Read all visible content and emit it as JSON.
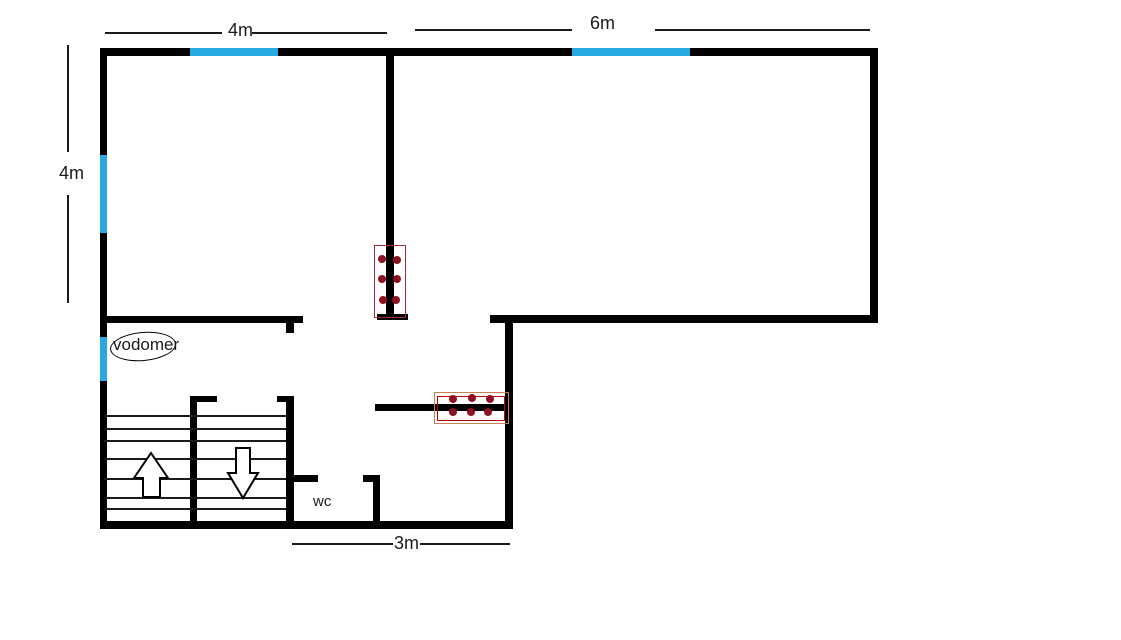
{
  "app": {
    "title": "floor-plan-sketch"
  },
  "labels": {
    "dim_top_left": "4m",
    "dim_top_right": "6m",
    "dim_left": "4m",
    "dim_bottom": "3m",
    "water_meter": "vodomer",
    "wc": "wc"
  },
  "colors": {
    "wall": "#000000",
    "window": "#29a9e1",
    "dim_line": "#1a1a1a",
    "step_line": "#1a1a1a",
    "dot": "#8e1023",
    "desk_outline_maroon": "#9b2c3b",
    "desk_outline_tan": "#c0824f",
    "desk_outline_red": "#c00000",
    "ellipse_stroke": "#000000"
  },
  "plan": {
    "walls": [
      {
        "name": "outer-top-wall",
        "x": 100,
        "y": 48,
        "w": 778,
        "h": 8
      },
      {
        "name": "outer-left-wall",
        "x": 100,
        "y": 48,
        "w": 7,
        "h": 480
      },
      {
        "name": "outer-right-wall",
        "x": 870,
        "y": 48,
        "w": 8,
        "h": 274
      },
      {
        "name": "right-room-bottom-wall",
        "x": 490,
        "y": 315,
        "w": 388,
        "h": 8
      },
      {
        "name": "hall-right-wall",
        "x": 505,
        "y": 319,
        "w": 8,
        "h": 209
      },
      {
        "name": "outer-bottom-wall",
        "x": 100,
        "y": 521,
        "w": 413,
        "h": 8
      },
      {
        "name": "center-partition-wall",
        "x": 386,
        "y": 56,
        "w": 8,
        "h": 260
      },
      {
        "name": "center-partition-foot",
        "x": 377,
        "y": 314,
        "w": 31,
        "h": 6
      },
      {
        "name": "left-room-bottom-wall",
        "x": 103,
        "y": 316,
        "w": 200,
        "h": 7
      },
      {
        "name": "left-room-wall-stub",
        "x": 286,
        "y": 323,
        "w": 8,
        "h": 10
      },
      {
        "name": "hall-desk-wall",
        "x": 375,
        "y": 404,
        "w": 132,
        "h": 7
      },
      {
        "name": "stairwell-right-wall",
        "x": 286,
        "y": 398,
        "w": 8,
        "h": 127
      },
      {
        "name": "stairwell-right-wall-stub",
        "x": 277,
        "y": 396,
        "w": 17,
        "h": 6
      },
      {
        "name": "stairs-divider-wall",
        "x": 190,
        "y": 399,
        "w": 7,
        "h": 126
      },
      {
        "name": "stairs-divider-stub",
        "x": 190,
        "y": 396,
        "w": 27,
        "h": 6
      },
      {
        "name": "wc-top-wall-left",
        "x": 286,
        "y": 475,
        "w": 32,
        "h": 7
      },
      {
        "name": "wc-top-wall-right",
        "x": 363,
        "y": 475,
        "w": 17,
        "h": 7
      },
      {
        "name": "wc-right-wall",
        "x": 373,
        "y": 475,
        "w": 7,
        "h": 52
      }
    ],
    "windows": [
      {
        "name": "window-top-left",
        "x": 190,
        "y": 48,
        "w": 88,
        "h": 8
      },
      {
        "name": "window-top-right",
        "x": 572,
        "y": 48,
        "w": 118,
        "h": 8
      },
      {
        "name": "window-left-upper",
        "x": 100,
        "y": 155,
        "w": 7,
        "h": 78
      },
      {
        "name": "window-left-lower",
        "x": 100,
        "y": 337,
        "w": 7,
        "h": 44
      }
    ],
    "dimension_lines": [
      {
        "name": "dim-line-4m-top-left-seg",
        "x": 105,
        "y": 32,
        "w": 117,
        "h": 2
      },
      {
        "name": "dim-line-4m-top-right-seg",
        "x": 252,
        "y": 32,
        "w": 135,
        "h": 2
      },
      {
        "name": "dim-line-6m-left-seg",
        "x": 415,
        "y": 29,
        "w": 157,
        "h": 2
      },
      {
        "name": "dim-line-6m-right-seg",
        "x": 655,
        "y": 29,
        "w": 215,
        "h": 2
      },
      {
        "name": "dim-line-left-4m-upper-seg",
        "x": 67,
        "y": 45,
        "w": 2,
        "h": 107
      },
      {
        "name": "dim-line-left-4m-lower-seg",
        "x": 67,
        "y": 195,
        "w": 2,
        "h": 108
      },
      {
        "name": "dim-line-3m-left-seg",
        "x": 292,
        "y": 543,
        "w": 101,
        "h": 2
      },
      {
        "name": "dim-line-3m-right-seg",
        "x": 420,
        "y": 543,
        "w": 90,
        "h": 2
      }
    ],
    "stairs": {
      "steps_x": 104,
      "steps_w": 182,
      "steps_thickness": 2,
      "steps_y": [
        415,
        428,
        440,
        458,
        478,
        497,
        508
      ]
    },
    "furniture": [
      {
        "name": "desk-block-vertical",
        "rects": [
          {
            "x": 374,
            "y": 245,
            "w": 30,
            "h": 71,
            "color_key": "desk_outline_maroon"
          }
        ],
        "dots": [
          {
            "x": 382,
            "y": 259
          },
          {
            "x": 397,
            "y": 260
          },
          {
            "x": 382,
            "y": 279
          },
          {
            "x": 397,
            "y": 279
          },
          {
            "x": 383,
            "y": 300
          },
          {
            "x": 396,
            "y": 300
          }
        ]
      },
      {
        "name": "desk-block-horizontal",
        "rects": [
          {
            "x": 434,
            "y": 392,
            "w": 73,
            "h": 30,
            "color_key": "desk_outline_tan"
          },
          {
            "x": 437,
            "y": 396,
            "w": 66,
            "h": 23,
            "color_key": "desk_outline_red"
          }
        ],
        "dots": [
          {
            "x": 453,
            "y": 399
          },
          {
            "x": 472,
            "y": 398
          },
          {
            "x": 490,
            "y": 399
          },
          {
            "x": 453,
            "y": 412
          },
          {
            "x": 471,
            "y": 412
          },
          {
            "x": 488,
            "y": 412
          }
        ]
      }
    ],
    "dot_radius": 4,
    "water_meter_ellipse": {
      "x": 110,
      "y": 332,
      "w": 64,
      "h": 27,
      "rotate_deg": -5
    }
  }
}
